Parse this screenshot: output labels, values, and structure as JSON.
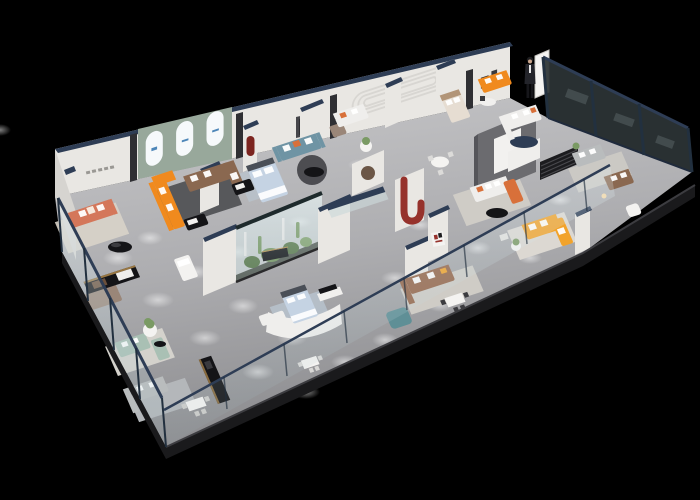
{
  "meta": {
    "description": "Isometric 3D cutaway render of a furniture showroom floor plan on a black background",
    "render_style": "3d-birdseye-cutaway",
    "legible_text": "none (wall signage too small to read)"
  },
  "palette": {
    "bg": "#000000",
    "floorTop": "#c3c3c5",
    "floorBottom": "#8e8e91",
    "slabEdge": "#1a1a1c",
    "slabLip": "#3c3c40",
    "wall": "#e9e7e3",
    "wallSide": "#d6d4d0",
    "wallShade": "#c7c5c1",
    "navy": "#2e3d55",
    "navyDeep": "#1f2a3c",
    "glassTint": "#cfe3e8",
    "glassDark": "#15191b",
    "glassSheen": "#9fb6ba",
    "frameDark": "#22303f",
    "sageWall": "#98a89b",
    "archWhite": "#f6f9fb",
    "logoBlue": "#4d86b8",
    "coral": "#d4775a",
    "orange": "#f08a1e",
    "yellow": "#f2a32b",
    "brown": "#8a6850",
    "leather": "#96664a",
    "taupe": "#9a8678",
    "slateTeal": "#6f94a4",
    "tealCube": "#5f8f96",
    "sageSofa": "#a9c0b4",
    "whiteSofa": "#efeeec",
    "graySofa": "#b9bcbd",
    "bedBlue": "#c5d3e3",
    "headboard": "#4a4f57",
    "red": "#96322c",
    "redDeep": "#7c241f",
    "green1": "#5d7b4d",
    "green2": "#7a9a64",
    "soil": "#3c4238",
    "black": "#141417",
    "gold": "#b98f4e",
    "wood": "#6b4f3a",
    "rugCream": "#d8d3c9",
    "rugDark": "#57585b",
    "rugBlue": "#b9c4cf",
    "rugLight": "#cfccc6",
    "cushionOrange": "#d8703a",
    "suit": "#23242a",
    "skin": "#caa58c"
  },
  "display_areas": [
    {
      "name": "coral sofa lounge",
      "accent": "#d4775a"
    },
    {
      "name": "arched gallery with orange and brown sectionals",
      "accent": "#f08a1e"
    },
    {
      "name": "slate-teal sofa lounge",
      "accent": "#6f94a4"
    },
    {
      "name": "cactus terrarium display",
      "accent": "#5d7b4d"
    },
    {
      "name": "feature wall lounge with orange chaise",
      "accent": "#d8703a"
    },
    {
      "name": "yellow sectional room",
      "accent": "#f2a32b"
    },
    {
      "name": "bedroom displays",
      "accent": "#c5d3e3"
    },
    {
      "name": "sage green lounge",
      "accent": "#a9c0b4"
    },
    {
      "name": "leather sectional by window",
      "accent": "#96664a"
    },
    {
      "name": "glass perimeter showcase",
      "accent": "#15191b"
    }
  ],
  "figures": [
    {
      "name": "salesperson standing by display board",
      "outfit": "#23242a"
    }
  ]
}
